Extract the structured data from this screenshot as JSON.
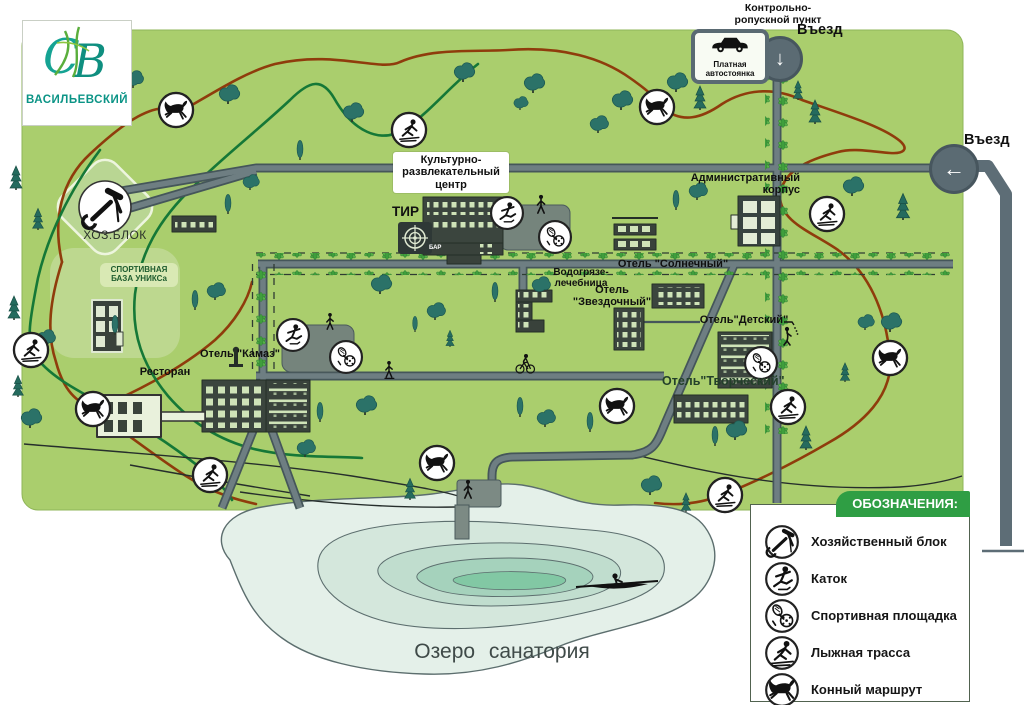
{
  "logo": {
    "monogram": "СВ",
    "name": "ВАСИЛЬЕВСКИЙ"
  },
  "entrances": {
    "checkpoint_label": "Контрольно-ропускной пункт",
    "entry_top": "Въезд",
    "entry_right": "Въезд",
    "parking": "Платная автостоянка"
  },
  "icons": {
    "down_arrow": "↓",
    "left_arrow": "←"
  },
  "places": {
    "cultural_center": "Культурно-развлекательный центр",
    "shooting_range": "ТИР",
    "bar": "БАР",
    "admin": "Административный корпус",
    "hydro_clinic": "Водогрязе-лечебница",
    "hotel_sunny": "Отель \"Солнечный\"",
    "hotel_star": "Отель \"Звездочный\"",
    "hotel_kids": "Отель\"Детский\"",
    "hotel_creative": "Отель\"Творческий\"",
    "hotel_kamaz": "Отель \"Камаз\"",
    "restaurant": "Ресторан",
    "utility_block": "ХОЗ.БЛОК",
    "sport_base": "СПОРТИВНАЯ БАЗА УНИКСа",
    "lake": "Озеро санатория"
  },
  "legend": {
    "title": "ОБОЗНАЧЕНИЯ:",
    "items": [
      {
        "icon": "tools-icon",
        "label": "Хозяйственный блок"
      },
      {
        "icon": "skater-icon",
        "label": "Каток"
      },
      {
        "icon": "sport-icon",
        "label": "Спортивная площадка"
      },
      {
        "icon": "ski-icon",
        "label": "Лыжная трасса"
      },
      {
        "icon": "horse-icon",
        "label": "Конный маршрут"
      }
    ]
  },
  "colors": {
    "map_green": "#aace6d",
    "road_gray": "#6d7d80",
    "trail_horse": "#8f3c0c",
    "trail_ski": "#157837",
    "lake_outer": "#e4f0e9",
    "legend_green": "#2f9e44",
    "logo_teal": "#12998a"
  }
}
